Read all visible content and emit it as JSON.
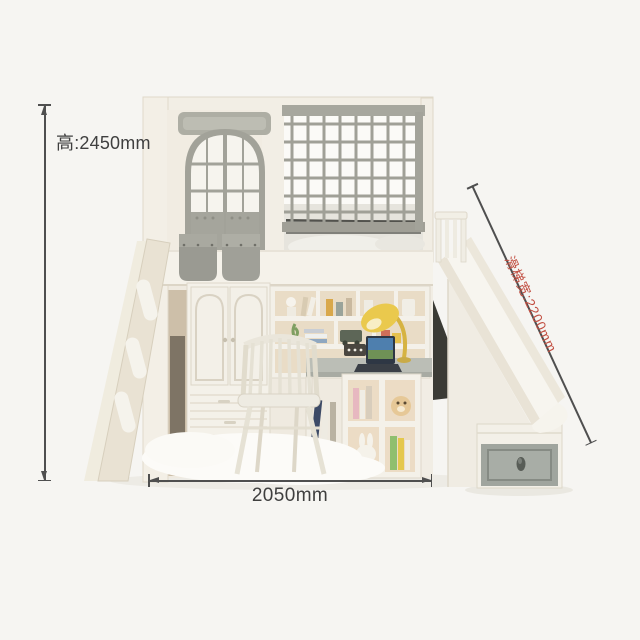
{
  "canvas": {
    "background": "#f6f5f2"
  },
  "annotations": {
    "height": {
      "label": "高:2450mm"
    },
    "width": {
      "label": "2050mm"
    },
    "slide": {
      "label": "滑梯宽:2200mm"
    }
  },
  "colors": {
    "dimension_line": "#4f4f4f",
    "dimension_text": "#3f3f3f",
    "slide_dimension_text": "#c24f42",
    "furniture_white": "#f4f1e9",
    "furniture_gray": "#a2a299",
    "wood_interior": "#e9dcc6"
  }
}
